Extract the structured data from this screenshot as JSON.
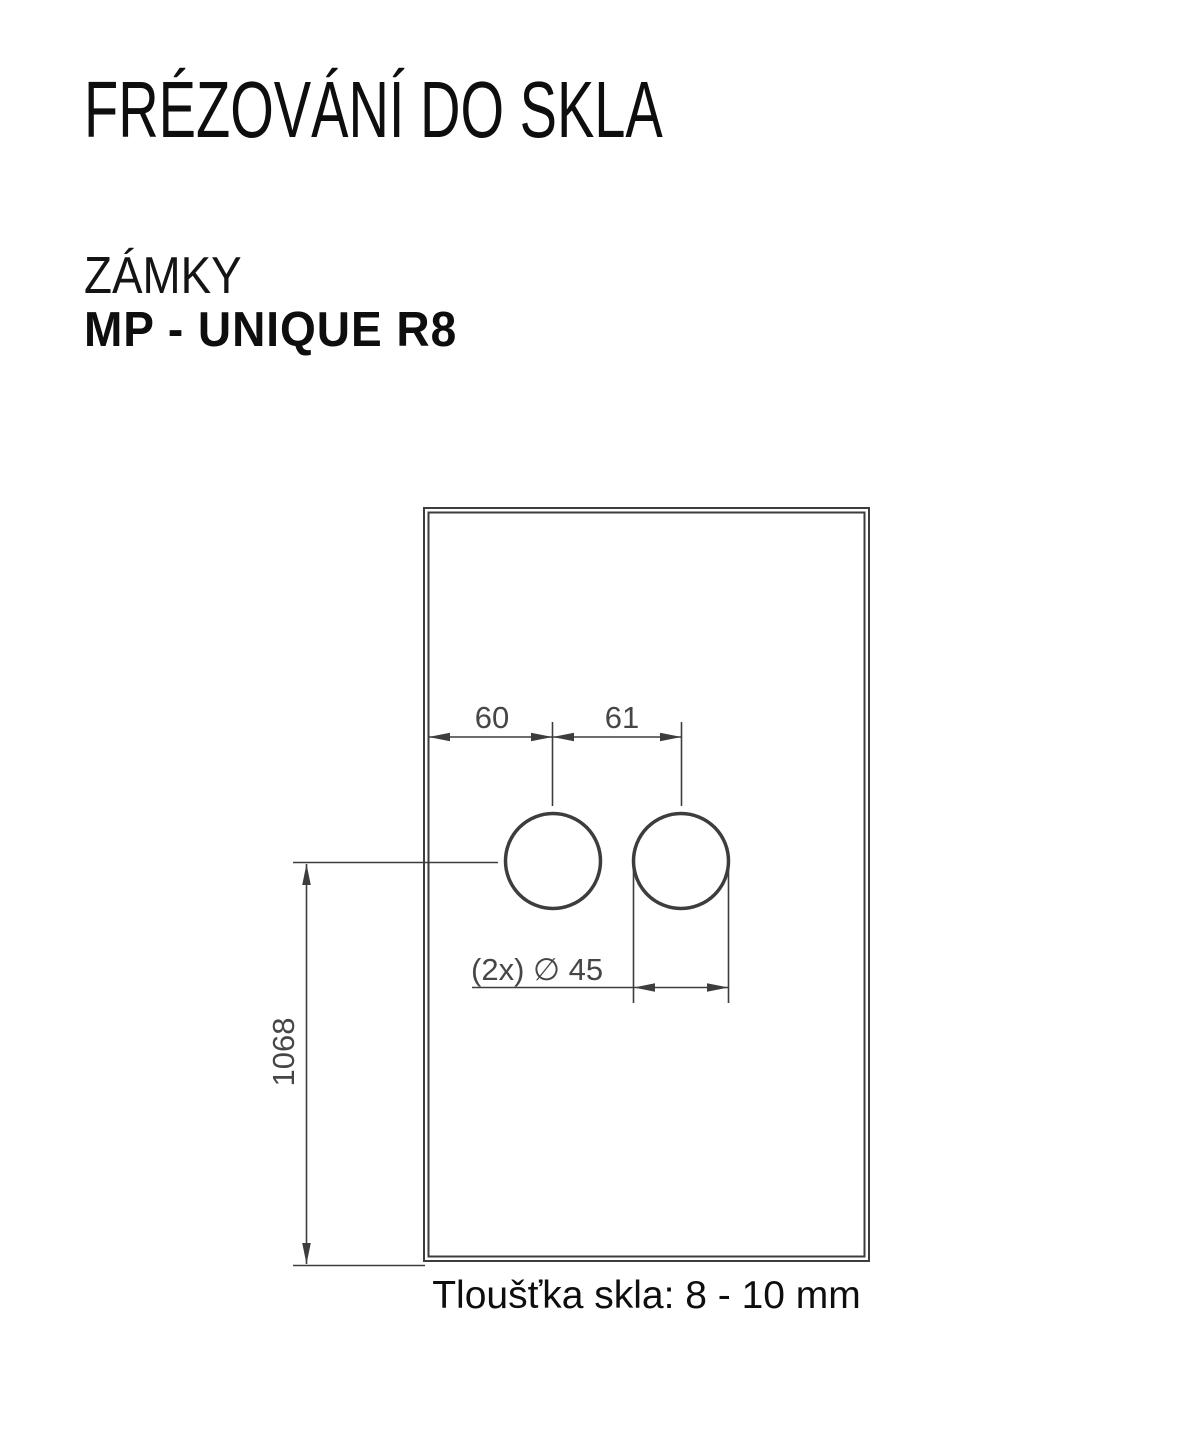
{
  "header": {
    "title": "FRÉZOVÁNÍ DO SKLA",
    "category": "ZÁMKY",
    "product": "MP - UNIQUE R8"
  },
  "drawing": {
    "type": "technical-drawing-glass-milling",
    "dim_edge_to_hole": "60",
    "dim_hole_spacing": "61",
    "dim_height": "1068",
    "dim_diameter": "(2x) ∅ 45",
    "holes_count": 2,
    "hole_diameter_mm": 45,
    "note": "Tloušťka skla: 8 - 10 mm",
    "colors": {
      "line": "#3d3d3d",
      "dimension_text": "#464646",
      "heading_text": "#0e0e0e"
    }
  }
}
